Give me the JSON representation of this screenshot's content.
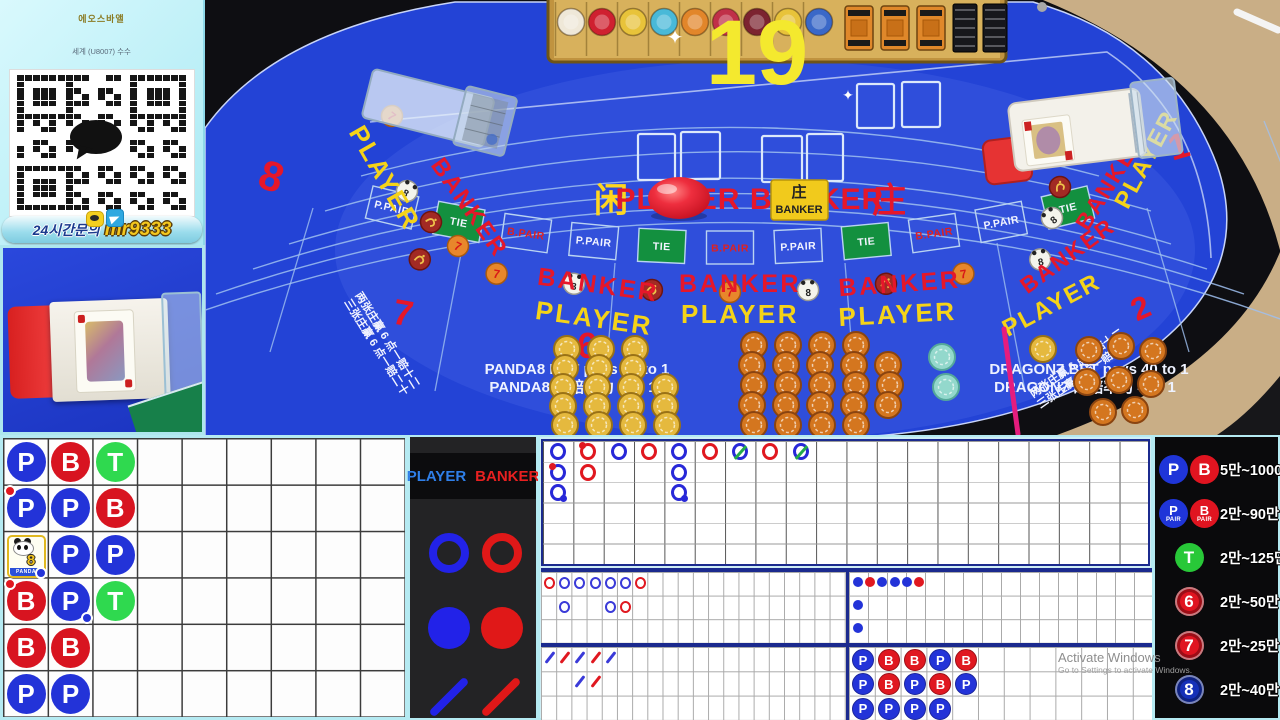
{
  "promo_panel": {
    "line1": "에오스바앨",
    "line2": "세계 (U8007) 수수",
    "banner_prefix": "24시간문의",
    "banner_id": "mr9333"
  },
  "table": {
    "count_display": "19",
    "sparkle": "✦",
    "center": {
      "left_cn": "闲",
      "left_en": "PLAYER",
      "right_en": "BANKER",
      "right_cn": "庄"
    },
    "plaque": {
      "cn": "庄",
      "en": "BANKER"
    },
    "words": {
      "banker": "BANKER",
      "player": "PLAYER"
    },
    "seats": {
      "s8": "8",
      "s7": "7",
      "s6": "6",
      "s2": "2",
      "s1": "1"
    },
    "ring_cells": [
      {
        "label": "P.PAIR",
        "kind": "ppair"
      },
      {
        "label": "TIE",
        "kind": "tie"
      },
      {
        "label": "B.PAIR",
        "kind": "bpair"
      },
      {
        "label": "P.PAIR",
        "kind": "ppair"
      },
      {
        "label": "TIE",
        "kind": "tie"
      },
      {
        "label": "B.PAIR",
        "kind": "bpair"
      },
      {
        "label": "P.PAIR",
        "kind": "ppair"
      },
      {
        "label": "TIE",
        "kind": "tie"
      },
      {
        "label": "B.PAIR",
        "kind": "bpair"
      },
      {
        "label": "P.PAIR",
        "kind": "ppair"
      },
      {
        "label": "TIE",
        "kind": "tie"
      }
    ],
    "ring_icons": [
      "dragon",
      "seven",
      "panda",
      "dragon",
      "seven",
      "panda",
      "dragon",
      "seven",
      "panda"
    ],
    "left_icons": [
      "seven",
      "panda",
      "dragon",
      "seven"
    ],
    "right_icons": [
      "seven",
      "dragon",
      "panda"
    ],
    "icon_glyphs": {
      "seven": "7",
      "panda": "8"
    },
    "payouts": {
      "panda_en": "PANDA8 BET pays 25 to 1",
      "panda_cn": "PANDA8 的赔率为 25 : 1",
      "dragon_en": "DRAGON7 BET pays 40 to 1",
      "dragon_cn": "DRAGON7 的赔率为 40 : 1",
      "super6_line1": "两张庄赢 6 点一赔十二",
      "super6_line2": "三张庄赢 6 点一赔二十"
    }
  },
  "legend": {
    "player": "PLAYER",
    "banker": "BANKER"
  },
  "bead_plate": {
    "rows": 6,
    "cols": 9,
    "panda_card": {
      "digit": "8",
      "label": "PANDA"
    },
    "cells": [
      {
        "r": 1,
        "c": 1,
        "kind": "P"
      },
      {
        "r": 1,
        "c": 2,
        "kind": "B"
      },
      {
        "r": 1,
        "c": 3,
        "kind": "T"
      },
      {
        "r": 2,
        "c": 1,
        "kind": "P",
        "ptl": true
      },
      {
        "r": 2,
        "c": 2,
        "kind": "P"
      },
      {
        "r": 2,
        "c": 3,
        "kind": "B"
      },
      {
        "r": 3,
        "c": 1,
        "kind": "PANDA8",
        "pbr": true
      },
      {
        "r": 3,
        "c": 2,
        "kind": "P"
      },
      {
        "r": 3,
        "c": 3,
        "kind": "P"
      },
      {
        "r": 4,
        "c": 1,
        "kind": "B",
        "ptl": true
      },
      {
        "r": 4,
        "c": 2,
        "kind": "P",
        "pbr": true
      },
      {
        "r": 4,
        "c": 3,
        "kind": "T"
      },
      {
        "r": 5,
        "c": 1,
        "kind": "B"
      },
      {
        "r": 5,
        "c": 2,
        "kind": "B"
      },
      {
        "r": 6,
        "c": 1,
        "kind": "P"
      },
      {
        "r": 6,
        "c": 2,
        "kind": "P"
      }
    ]
  },
  "big_road": {
    "rows": 6,
    "cols": 20,
    "cells": [
      {
        "c": 1,
        "r": 1,
        "color": "blue"
      },
      {
        "c": 1,
        "r": 2,
        "color": "blue",
        "ptl": true
      },
      {
        "c": 1,
        "r": 3,
        "color": "blue",
        "pbr": true
      },
      {
        "c": 2,
        "r": 1,
        "color": "red",
        "ptl": true
      },
      {
        "c": 2,
        "r": 2,
        "color": "red"
      },
      {
        "c": 3,
        "r": 1,
        "color": "blue"
      },
      {
        "c": 4,
        "r": 1,
        "color": "red"
      },
      {
        "c": 5,
        "r": 1,
        "color": "blue"
      },
      {
        "c": 5,
        "r": 2,
        "color": "blue"
      },
      {
        "c": 5,
        "r": 3,
        "color": "blue",
        "pbr": true
      },
      {
        "c": 6,
        "r": 1,
        "color": "red"
      },
      {
        "c": 7,
        "r": 1,
        "color": "blue",
        "tie": true
      },
      {
        "c": 8,
        "r": 1,
        "color": "red"
      },
      {
        "c": 9,
        "r": 1,
        "color": "blue",
        "tie": true
      }
    ]
  },
  "big_eye_road": {
    "rows": 3,
    "cols": 20,
    "cells": [
      {
        "c": 1,
        "r": 1,
        "color": "red"
      },
      {
        "c": 2,
        "r": 1,
        "color": "blue"
      },
      {
        "c": 3,
        "r": 1,
        "color": "blue"
      },
      {
        "c": 4,
        "r": 1,
        "color": "blue"
      },
      {
        "c": 5,
        "r": 1,
        "color": "blue"
      },
      {
        "c": 6,
        "r": 1,
        "color": "blue"
      },
      {
        "c": 7,
        "r": 1,
        "color": "red"
      },
      {
        "c": 2,
        "r": 2,
        "color": "blue"
      },
      {
        "c": 5,
        "r": 2,
        "color": "blue"
      },
      {
        "c": 6,
        "r": 2,
        "color": "red"
      }
    ]
  },
  "small_road": {
    "rows": 3,
    "cols": 20,
    "cells": [
      {
        "c": 1,
        "r": 1,
        "color": "blue"
      },
      {
        "c": 2,
        "r": 1,
        "color": "red"
      },
      {
        "c": 3,
        "r": 1,
        "color": "blue"
      },
      {
        "c": 4,
        "r": 1,
        "color": "red"
      },
      {
        "c": 5,
        "r": 1,
        "color": "blue"
      },
      {
        "c": 3,
        "r": 2,
        "color": "blue"
      },
      {
        "c": 4,
        "r": 2,
        "color": "red"
      }
    ]
  },
  "right_dot_road": {
    "rows": 3,
    "cols": 25,
    "cells": [
      {
        "c": 1,
        "r": 1,
        "color": "blue"
      },
      {
        "c": 2,
        "r": 1,
        "color": "red"
      },
      {
        "c": 3,
        "r": 1,
        "color": "blue"
      },
      {
        "c": 4,
        "r": 1,
        "color": "blue"
      },
      {
        "c": 5,
        "r": 1,
        "color": "blue"
      },
      {
        "c": 6,
        "r": 1,
        "color": "red"
      },
      {
        "c": 1,
        "r": 2,
        "color": "blue"
      },
      {
        "c": 1,
        "r": 3,
        "color": "blue"
      }
    ]
  },
  "ask_road": {
    "rows": [
      [
        "P",
        "B",
        "B",
        "P",
        "B"
      ],
      [
        "P",
        "B",
        "P",
        "B",
        "P"
      ],
      [
        "P",
        "P",
        "P",
        "P"
      ]
    ]
  },
  "limits": {
    "rows": [
      {
        "icons": [
          {
            "t": "P",
            "c": "blue"
          },
          {
            "t": "B",
            "c": "red"
          }
        ],
        "range": "5만~1000만"
      },
      {
        "icons": [
          {
            "t": "P",
            "sub": "PAIR",
            "c": "blue"
          },
          {
            "t": "B",
            "sub": "PAIR",
            "c": "red"
          }
        ],
        "range": "2만~90만"
      },
      {
        "icons": [
          {
            "t": "T",
            "c": "green"
          }
        ],
        "range": "2만~125만"
      },
      {
        "icons": [
          {
            "t": "6",
            "c": "red",
            "ring": true
          }
        ],
        "range": "2만~50만"
      },
      {
        "icons": [
          {
            "t": "7",
            "c": "red",
            "ring": true
          }
        ],
        "range": "2만~25만"
      },
      {
        "icons": [
          {
            "t": "8",
            "c": "navy",
            "ring": true
          }
        ],
        "range": "2만~40만"
      }
    ]
  },
  "watermark": {
    "line1": "Activate Windows",
    "line2": "Go to Settings to activate Windows."
  },
  "colors": {
    "player_blue": "#2333d8",
    "banker_red": "#dd1622",
    "tie_green": "#2fd94f",
    "road_blue": "#2b2bd8",
    "road_red": "#e01820",
    "tie_slash": "#23a94c",
    "gold_chip": "#e5b93e",
    "orange_chip": "#d4761f",
    "teal_chip": "#93d8cc",
    "pink": "#e51c7e",
    "felt": "#2343d6",
    "cyan_frame": "#b5eaf2"
  }
}
